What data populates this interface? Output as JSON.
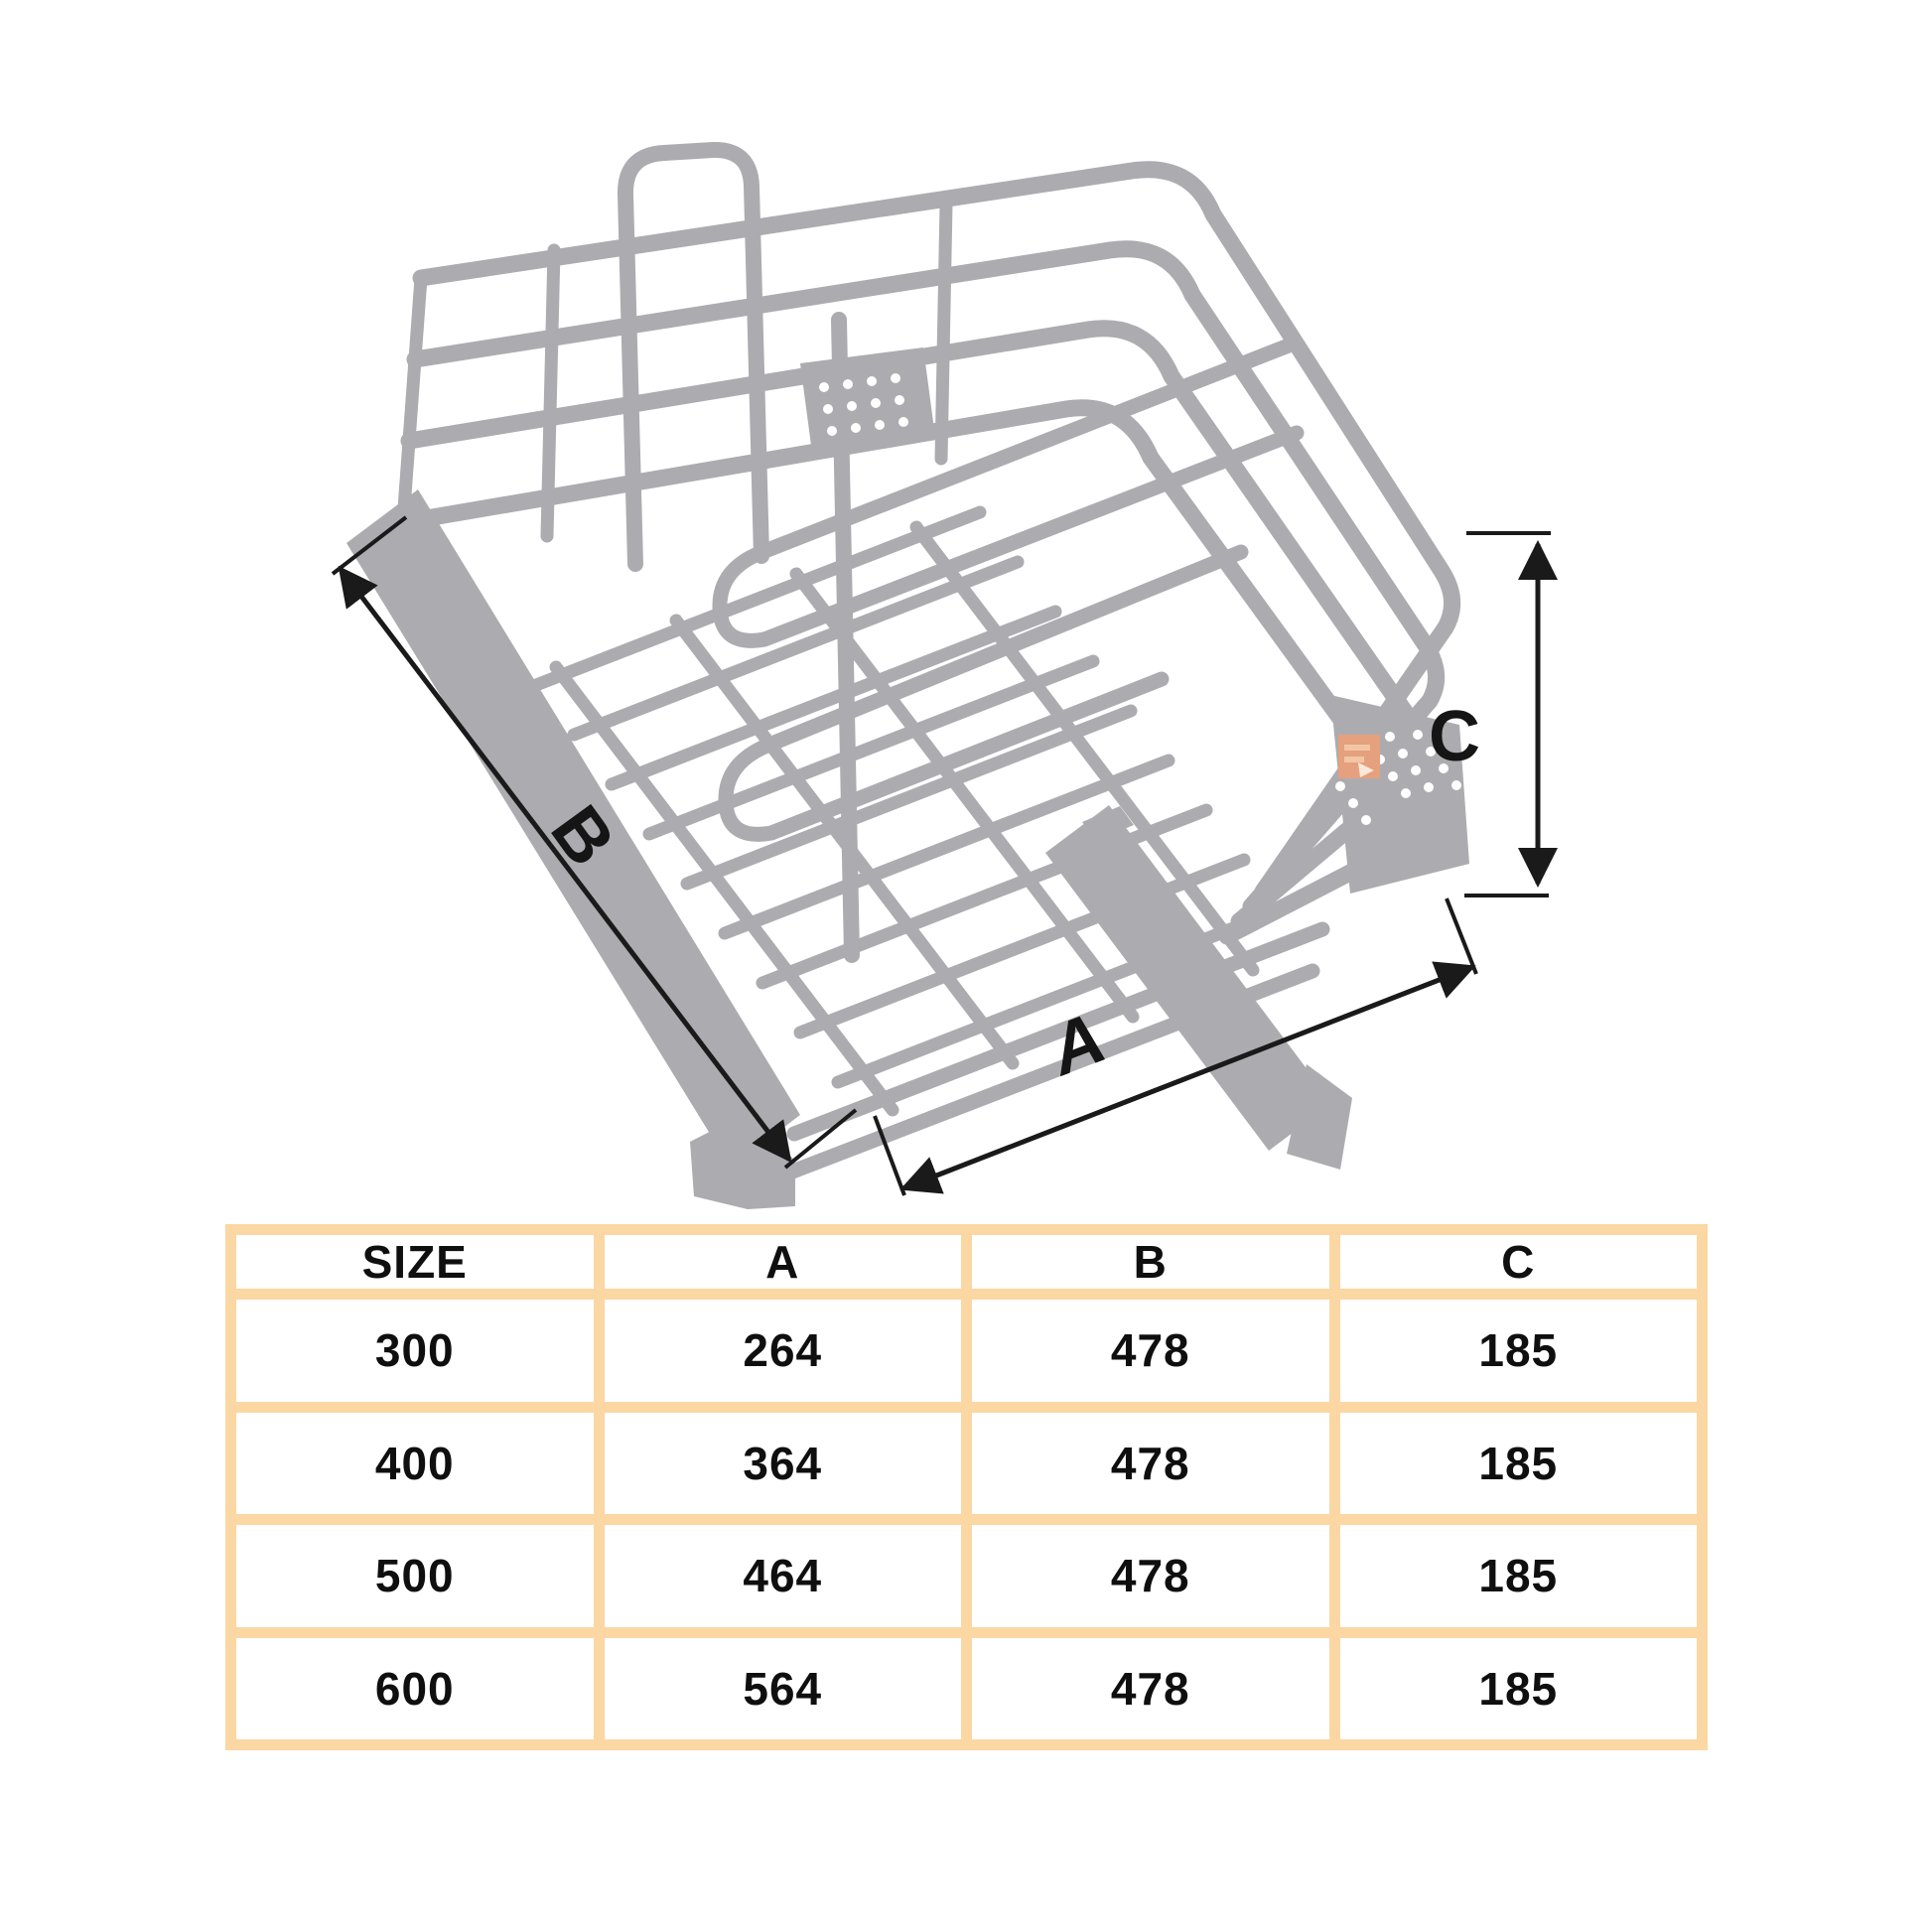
{
  "sheet": {
    "background_color": "#FFFFFF",
    "description_labels": {
      "a": "A",
      "b": "B",
      "c": "C"
    },
    "diagram": {
      "wire_color": "#ACACB0",
      "dimension_color": "#1A1A1A",
      "watermark_color": "#E5A07D"
    }
  },
  "table": {
    "border_color": "#FAD7A3",
    "headers": [
      "SIZE",
      "A",
      "B",
      "C"
    ],
    "rows": [
      [
        "300",
        "264",
        "478",
        "185"
      ],
      [
        "400",
        "364",
        "478",
        "185"
      ],
      [
        "500",
        "464",
        "478",
        "185"
      ],
      [
        "600",
        "564",
        "478",
        "185"
      ]
    ]
  }
}
